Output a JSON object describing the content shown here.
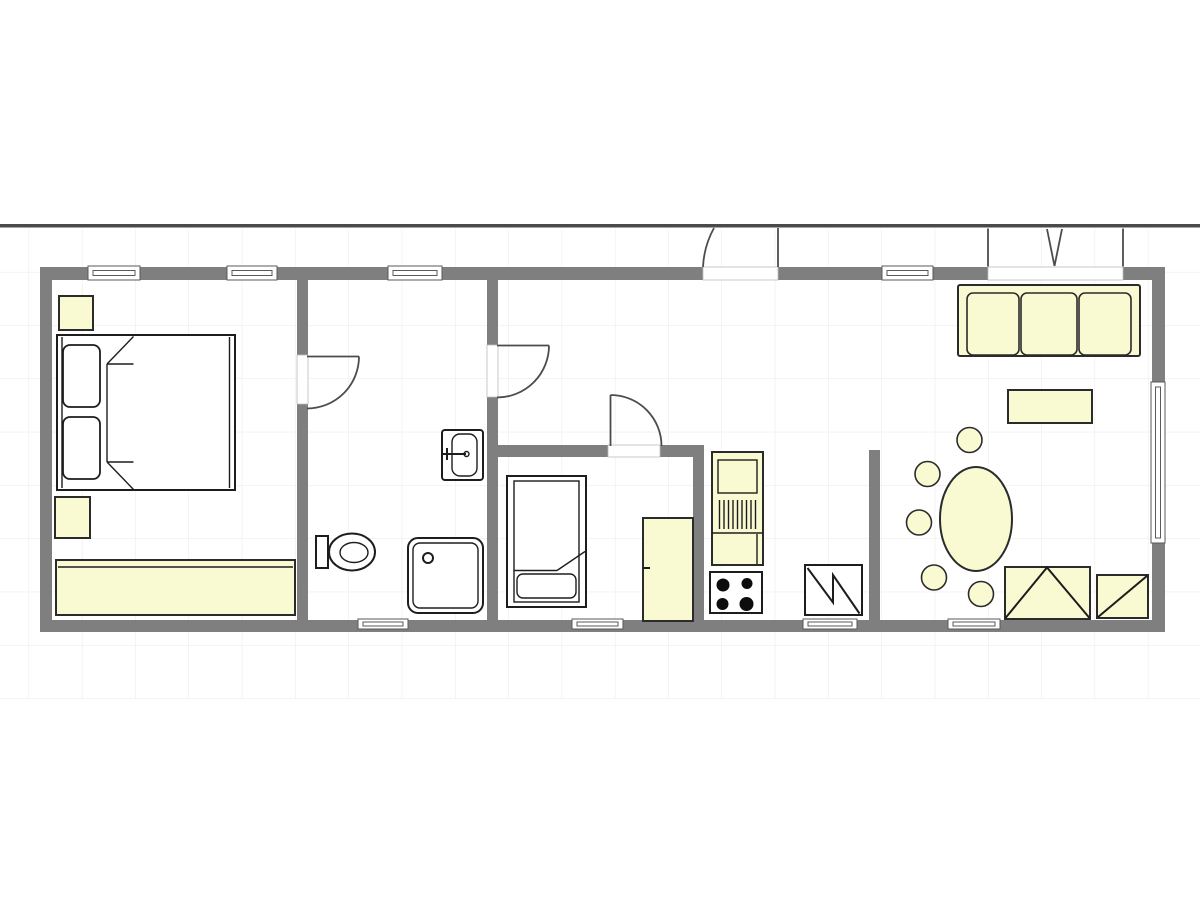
{
  "document": {
    "type": "architectural-floor-plan",
    "canvas": {
      "width": 1200,
      "height": 900
    },
    "visible_text": "none"
  },
  "palette": {
    "paper": "#ffffff",
    "grid": "#ece9e5",
    "boundary": "#4a4a4a",
    "wall": "#7f7f7f",
    "furniture_fill": "#fafad2",
    "outline": "#2b2b2b",
    "fixture_fill": "#ffffff"
  },
  "plan": {
    "rooms": [
      {
        "name": "master-bedroom",
        "furniture": [
          "double-bed",
          "nightstand",
          "nightstand",
          "dresser"
        ]
      },
      {
        "name": "bathroom",
        "fixtures": [
          "toilet",
          "washbasin",
          "shower"
        ]
      },
      {
        "name": "hallway",
        "connects": [
          "bathroom",
          "small-bedroom",
          "entrance",
          "kitchen"
        ]
      },
      {
        "name": "small-bedroom",
        "furniture": [
          "single-bed",
          "wardrobe"
        ]
      },
      {
        "name": "kitchen",
        "fixtures": [
          "kitchen-unit-with-sink",
          "cooktop-4-burner",
          "appliance-square"
        ]
      },
      {
        "name": "living-dining",
        "furniture": [
          "sofa-3-seat",
          "coffee-table",
          "oval-dining-table",
          "round-chair",
          "round-chair",
          "round-chair",
          "round-chair",
          "round-chair",
          "armchair",
          "armchair"
        ]
      }
    ],
    "openings": {
      "windows_top_wall": 4,
      "windows_bottom_wall": 4,
      "windows_right_wall": 1,
      "entrance_door_outward": 1,
      "terrace_double_door": 1,
      "interior_doors": 3
    }
  }
}
